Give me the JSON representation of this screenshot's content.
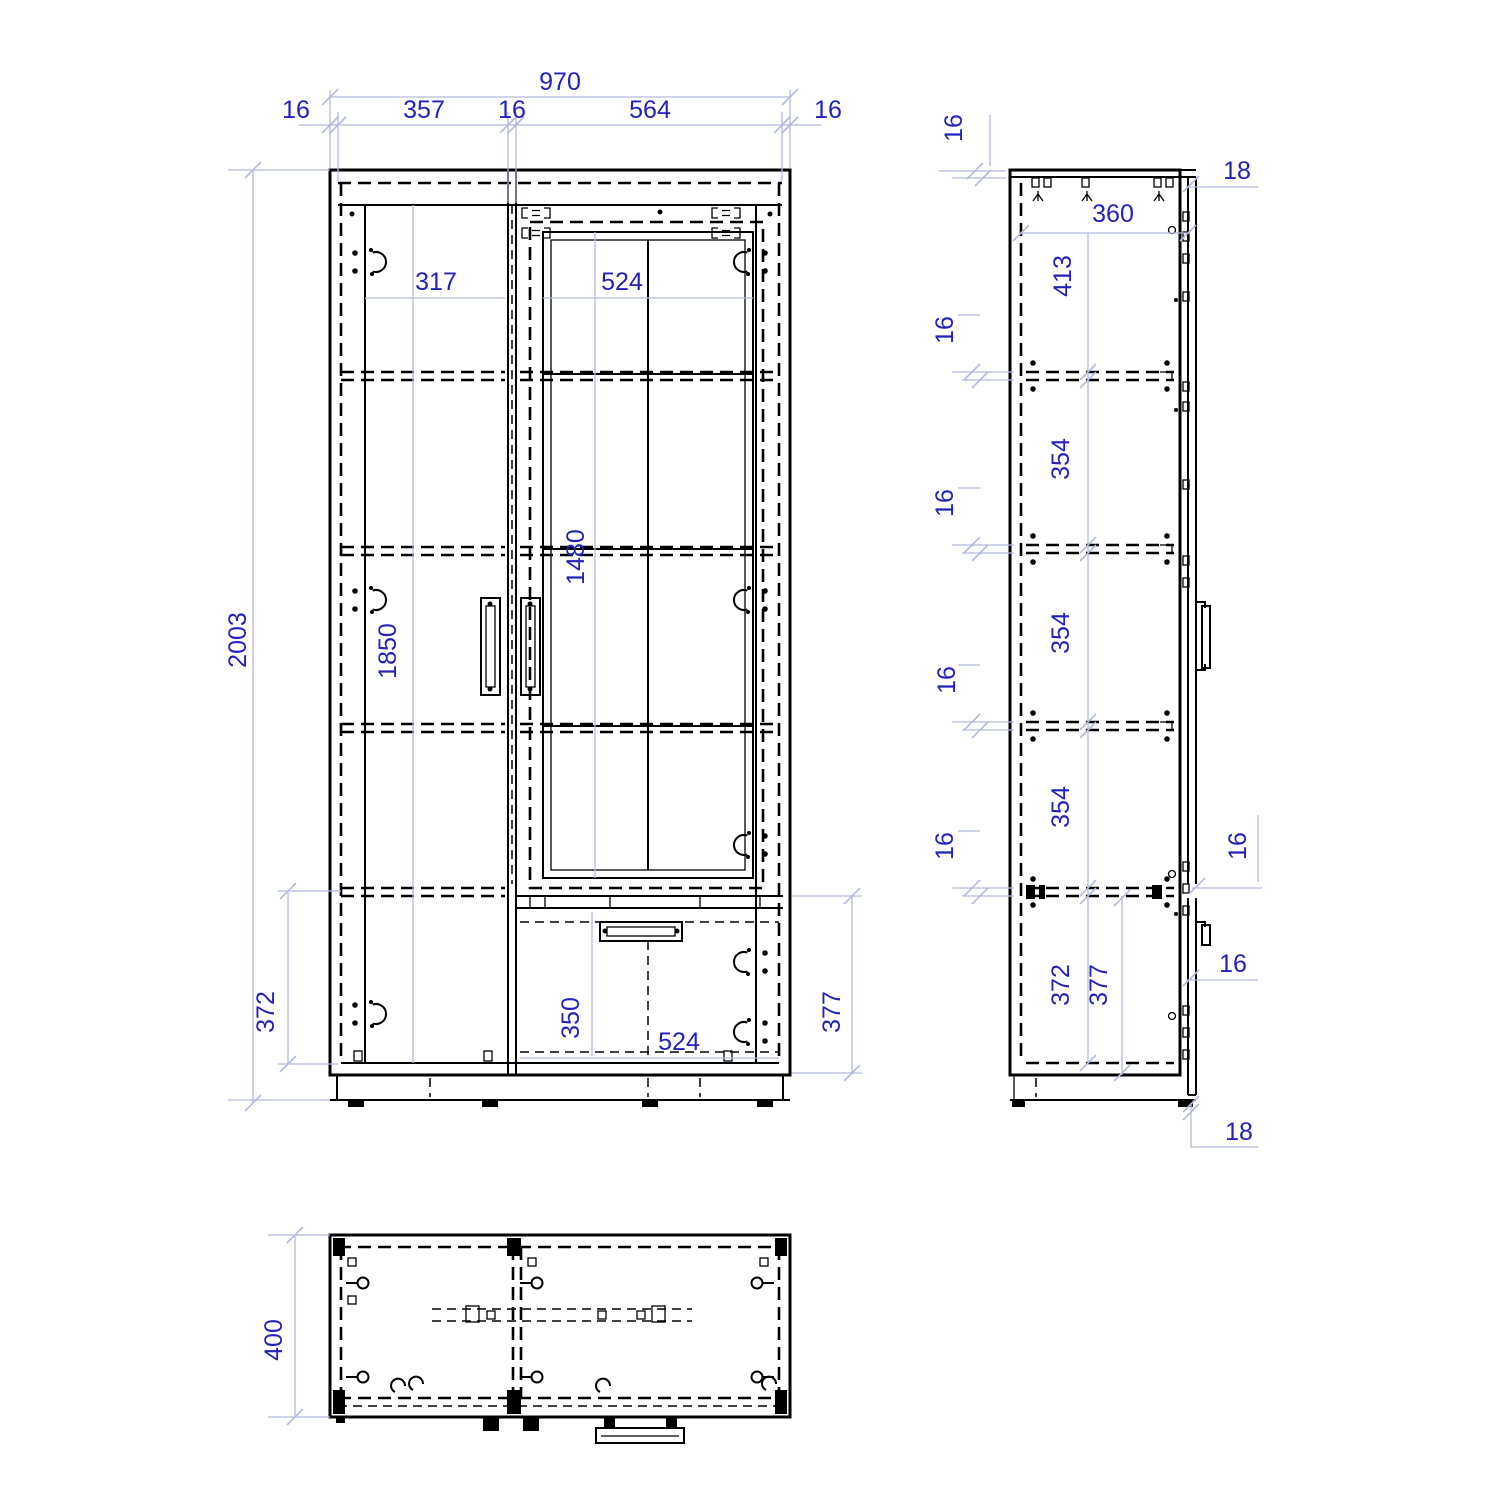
{
  "colors": {
    "background": "#ffffff",
    "drawing_line": "#000000",
    "dimension_text": "#2222bb",
    "dimension_line": "#b4badf"
  },
  "front_view": {
    "overall_width": "970",
    "left_panel_thickness": "16",
    "left_opening": "357",
    "partition_thickness": "16",
    "right_opening": "564",
    "right_panel_thickness": "16",
    "overall_height": "2003",
    "shelf_width": "317",
    "glass_door_width": "524",
    "glass_height": "1480",
    "door_height": "1850",
    "left_bottom_section": "372",
    "drawer_height": "350",
    "drawer_width": "524",
    "right_bottom_section": "377"
  },
  "side_view": {
    "top_panel_thickness": "16",
    "door_front_offset": "18",
    "inner_depth": "360",
    "top_section": "413",
    "sections": [
      "354",
      "354",
      "354"
    ],
    "shelf_thicknesses": [
      "16",
      "16",
      "16",
      "16"
    ],
    "door_gap": "16",
    "front_gap": "16",
    "bottom_section_back": "372",
    "bottom_section_front": "377",
    "bottom_offset": "18"
  },
  "top_view": {
    "depth": "400"
  }
}
